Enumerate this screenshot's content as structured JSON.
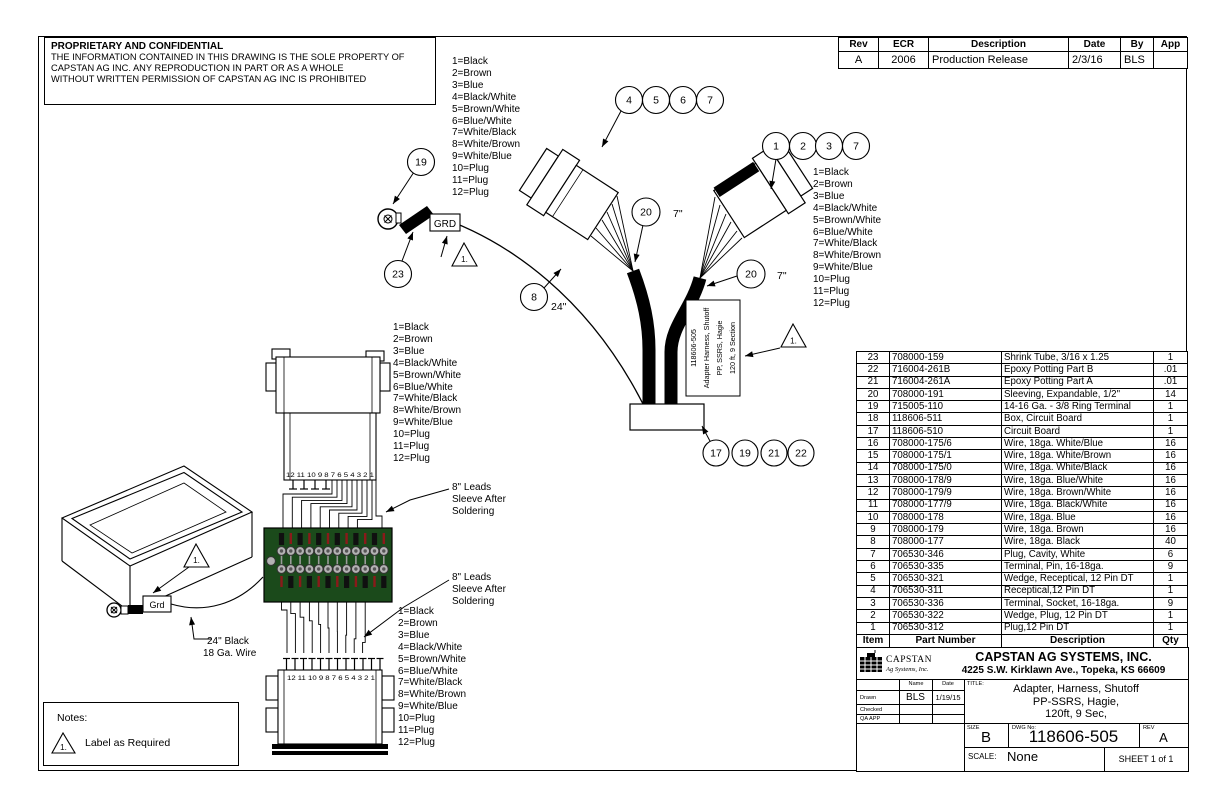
{
  "sheet": {
    "proprietary": {
      "title": "PROPRIETARY AND CONFIDENTIAL",
      "lines": [
        "THE INFORMATION CONTAINED IN THIS DRAWING IS THE SOLE PROPERTY OF",
        "CAPSTAN AG INC. ANY REPRODUCTION IN PART OR AS A WHOLE",
        "WITHOUT WRITTEN PERMISSION OF CAPSTAN AG INC IS PROHIBITED"
      ]
    },
    "revision_table": {
      "headers": [
        "Rev",
        "ECR",
        "Description",
        "Date",
        "By",
        "App"
      ],
      "row": {
        "rev": "A",
        "ecr": "2006",
        "description": "Production Release",
        "date": "2/3/16",
        "by": "BLS",
        "app": ""
      }
    },
    "parts_table": {
      "headers": [
        "Item",
        "Part Number",
        "Description",
        "Qty"
      ],
      "rows": [
        [
          "23",
          "708000-159",
          "Shrink Tube, 3/16 x 1.25",
          "1"
        ],
        [
          "22",
          "716004-261B",
          "Epoxy Potting Part B",
          ".01"
        ],
        [
          "21",
          "716004-261A",
          "Epoxy Potting Part A",
          ".01"
        ],
        [
          "20",
          "708000-191",
          "Sleeving, Expandable, 1/2\"",
          "14"
        ],
        [
          "19",
          "715005-110",
          "14-16 Ga. - 3/8 Ring Terminal",
          "1"
        ],
        [
          "18",
          "118606-511",
          "Box, Circuit Board",
          "1"
        ],
        [
          "17",
          "118606-510",
          "Circuit Board",
          "1"
        ],
        [
          "16",
          "708000-175/6",
          "Wire, 18ga. White/Blue",
          "16"
        ],
        [
          "15",
          "708000-175/1",
          "Wire, 18ga. White/Brown",
          "16"
        ],
        [
          "14",
          "708000-175/0",
          "Wire, 18ga. White/Black",
          "16"
        ],
        [
          "13",
          "708000-178/9",
          "Wire, 18ga. Blue/White",
          "16"
        ],
        [
          "12",
          "708000-179/9",
          "Wire, 18ga. Brown/White",
          "16"
        ],
        [
          "11",
          "708000-177/9",
          "Wire, 18ga. Black/White",
          "16"
        ],
        [
          "10",
          "708000-178",
          "Wire, 18ga. Blue",
          "16"
        ],
        [
          "9",
          "708000-179",
          "Wire, 18ga. Brown",
          "16"
        ],
        [
          "8",
          "708000-177",
          "Wire, 18ga. Black",
          "40"
        ],
        [
          "7",
          "706530-346",
          "Plug, Cavity, White",
          "6"
        ],
        [
          "6",
          "706530-335",
          "Terminal, Pin, 16-18ga.",
          "9"
        ],
        [
          "5",
          "706530-321",
          "Wedge, Receptical, 12 Pin DT",
          "1"
        ],
        [
          "4",
          "706530-311",
          "Receptical,12 Pin DT",
          "1"
        ],
        [
          "3",
          "706530-336",
          "Terminal, Socket, 16-18ga.",
          "9"
        ],
        [
          "2",
          "706530-322",
          "Wedge, Plug, 12 Pin DT",
          "1"
        ],
        [
          "1",
          "706530-312",
          "Plug,12 Pin DT",
          "1"
        ]
      ]
    },
    "title_block": {
      "logo_text": "CAPSTAN",
      "logo_subtext": "Ag Systems, Inc.",
      "company": "CAPSTAN AG SYSTEMS, INC.",
      "address": "4225 S.W. Kirklawn Ave., Topeka, KS 66609",
      "name_header": "Name",
      "date_header": "Date",
      "drawn_label": "Drawn",
      "drawn_name": "BLS",
      "drawn_date": "1/19/15",
      "checked_label": "Checked",
      "qa_label": "QA APP",
      "title_label": "TITLE:",
      "title_lines": [
        "Adapter, Harness, Shutoff",
        "PP-SSRS, Hagie,",
        "120ft, 9 Sec,"
      ],
      "size_label": "SIZE",
      "size": "B",
      "dwg_label": "DWG No:",
      "dwg_no": "118606-505",
      "rev_label": "REV",
      "rev": "A",
      "scale_label": "SCALE:",
      "scale": "None",
      "sheet_label": "SHEET 1 of 1"
    },
    "notes": {
      "heading": "Notes:",
      "flag": "1.",
      "text": "Label as Required"
    }
  },
  "drawing": {
    "wire_legend": [
      "1=Black",
      "2=Brown",
      "3=Blue",
      "4=Black/White",
      "5=Brown/White",
      "6=Blue/White",
      "7=White/Black",
      "8=White/Brown",
      "9=White/Blue",
      "10=Plug",
      "11=Plug",
      "12=Plug"
    ],
    "balloons": {
      "top": [
        "4",
        "5",
        "6",
        "7"
      ],
      "right": [
        "1",
        "2",
        "3",
        "7"
      ],
      "bottom": [
        "17",
        "19",
        "21",
        "22"
      ],
      "ring_terminal": "19",
      "shrink_tube": "23",
      "ground_wire": "8",
      "sleeve_left": "20",
      "sleeve_right": "20"
    },
    "dims": {
      "sleeve_left": "7\"",
      "sleeve_right": "7\"",
      "ground_wire": "24\""
    },
    "labels": {
      "grd_upper": "GRD",
      "grd_lower": "Grd",
      "pin_numbers": "12 11 10 9 8 7 6 5 4 3 2 1",
      "note_flag": "1."
    },
    "harness_label": [
      "118606-505",
      "Adapter Harness, Shutoff",
      "PP, SSRS, Hagie",
      "120 ft, 9 Section"
    ],
    "leads_note": [
      "8\" Leads",
      "Sleeve After",
      "Soldering"
    ],
    "ground_wire_note": [
      "24\" Black",
      "18 Ga. Wire"
    ],
    "colors": {
      "board_green": "#1b4a1b",
      "pad_gray": "#b3b3b3",
      "silk_red": "#8b1a1a"
    }
  }
}
